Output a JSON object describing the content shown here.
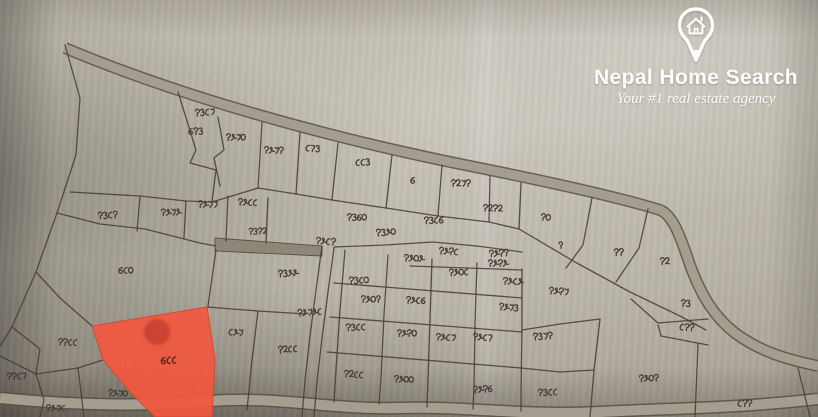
{
  "branding": {
    "name": "Nepal Home Search",
    "tagline": "Your #1 real estate agency",
    "icon": "home-location-pin-icon",
    "text_color": "#ffffff"
  },
  "map": {
    "description": "hand-drawn cadastral parcel sheet photograph with Devanagari plot numbers",
    "colors": {
      "ink": "#463f33",
      "road_fill": "#a59e90",
      "road_edge": "#575045",
      "strip_fill": "#8e8779",
      "paper": "#bab5a9",
      "highlight": "#f2583e",
      "highlight_label": "#63271a",
      "marker": "#c03a2e"
    },
    "highlight": {
      "label": "६८८",
      "label_pos": {
        "x": 168,
        "y": 360
      },
      "polygon": "92,326 207,307 215,360 212,417 155,417 130,392 103,360",
      "marker": {
        "cx": 157,
        "cy": 332,
        "r": 13
      }
    },
    "roads": [
      {
        "name": "top-road",
        "d": "M65,48 C160,88 300,132 470,166 C560,184 625,199 660,210 C673,215 681,238 690,265 C700,292 712,315 735,333 C762,353 790,360 818,366",
        "width": 9
      },
      {
        "name": "bottom-road",
        "d": "M0,398 C80,406 150,406 210,401 C280,396 330,410 400,408 C470,406 520,416 600,412 C680,408 740,408 818,399",
        "width": 10
      }
    ],
    "road_strip": {
      "points": "215,238 322,246 322,256 215,251",
      "label": "१३१२",
      "label_pos": {
        "x": 257,
        "y": 231
      }
    },
    "lines": [
      "65,45 80,98 76,155 57,213 36,272 12,327 0,346",
      "178,92 196,150 190,163 216,170 212,202",
      "218,117 224,150 214,158 220,186",
      "262,122 258,188",
      "300,133 296,194",
      "338,143 332,200",
      "392,155 386,208",
      "442,165 438,216",
      "490,176 489,222",
      "521,183 519,229",
      "70,192 140,196 186,201 212,202",
      "140,196 137,231",
      "186,201 184,238",
      "228,196 226,241",
      "268,198 266,243",
      "212,202 258,188 296,194 332,200 386,208 438,216 489,222 519,229",
      "519,229 575,262 630,292 680,316 706,330",
      "592,198 583,245 566,268",
      "648,209 639,248 616,282",
      "631,299 658,323",
      "658,323 708,319",
      "658,325 661,336 708,345",
      "600,319 594,370 590,417",
      "698,344 695,417",
      "798,368 810,417",
      "522,330 560,324 600,319",
      "521,368 560,372 594,370",
      "57,213 100,224 145,229 200,243 216,246",
      "334,247 385,245 433,242 477,246 522,252",
      "410,266 522,270",
      "334,283 522,298",
      "330,317 522,332",
      "327,352 521,368",
      "345,250 340,310 336,370 334,402",
      "388,255 384,315 381,378 379,404",
      "432,259 430,320 428,380 427,407",
      "477,263 475,324 474,384 473,409",
      "522,269 522,330 521,392 521,411",
      "322,246 316,290 310,336 305,380 302,417",
      "334,248 328,292 322,338 317,382 314,417",
      "216,250 208,306",
      "207,307 258,311 306,314",
      "36,272 60,298 92,326",
      "258,311 252,360 247,410",
      "12,327 40,349 36,374",
      "0,356 36,374",
      "36,374 78,368 103,360",
      "78,368 84,417",
      "36,374 44,400 40,417"
    ],
    "labels": [
      {
        "x": 204,
        "y": 112,
        "t": "१३८७"
      },
      {
        "x": 195,
        "y": 131,
        "t": "६९३"
      },
      {
        "x": 235,
        "y": 137,
        "t": "१४७०"
      },
      {
        "x": 273,
        "y": 150,
        "t": "१४७१"
      },
      {
        "x": 312,
        "y": 148,
        "t": "८५३"
      },
      {
        "x": 362,
        "y": 162,
        "t": "८८३"
      },
      {
        "x": 412,
        "y": 180,
        "t": "६"
      },
      {
        "x": 460,
        "y": 183,
        "t": "१२७१"
      },
      {
        "x": 492,
        "y": 208,
        "t": "१२१२"
      },
      {
        "x": 545,
        "y": 217,
        "t": "१०"
      },
      {
        "x": 560,
        "y": 245,
        "t": "९"
      },
      {
        "x": 618,
        "y": 252,
        "t": "११"
      },
      {
        "x": 664,
        "y": 261,
        "t": "१२"
      },
      {
        "x": 685,
        "y": 303,
        "t": "१३"
      },
      {
        "x": 686,
        "y": 327,
        "t": "८११"
      },
      {
        "x": 107,
        "y": 215,
        "t": "१३८१"
      },
      {
        "x": 170,
        "y": 212,
        "t": "१४७४"
      },
      {
        "x": 207,
        "y": 204,
        "t": "१४७७"
      },
      {
        "x": 247,
        "y": 202,
        "t": "१४८८"
      },
      {
        "x": 325,
        "y": 241,
        "t": "१४८१"
      },
      {
        "x": 385,
        "y": 232,
        "t": "१३४०"
      },
      {
        "x": 433,
        "y": 220,
        "t": "१३८६"
      },
      {
        "x": 356,
        "y": 217,
        "t": "१३६०"
      },
      {
        "x": 413,
        "y": 258,
        "t": "१४०४"
      },
      {
        "x": 448,
        "y": 251,
        "t": "१४१८"
      },
      {
        "x": 498,
        "y": 253,
        "t": "१४१९"
      },
      {
        "x": 458,
        "y": 272,
        "t": "१४०८"
      },
      {
        "x": 497,
        "y": 263,
        "t": "१४१४"
      },
      {
        "x": 512,
        "y": 281,
        "t": "१४८४"
      },
      {
        "x": 558,
        "y": 291,
        "t": "१४१७"
      },
      {
        "x": 287,
        "y": 273,
        "t": "१३४४"
      },
      {
        "x": 358,
        "y": 280,
        "t": "१३८०"
      },
      {
        "x": 370,
        "y": 299,
        "t": "१४०९"
      },
      {
        "x": 415,
        "y": 300,
        "t": "१४८६"
      },
      {
        "x": 508,
        "y": 307,
        "t": "१४७३"
      },
      {
        "x": 309,
        "y": 312,
        "t": "१४७४८"
      },
      {
        "x": 355,
        "y": 327,
        "t": "१३८८"
      },
      {
        "x": 406,
        "y": 333,
        "t": "१४१०"
      },
      {
        "x": 445,
        "y": 337,
        "t": "१४८७"
      },
      {
        "x": 482,
        "y": 337,
        "t": "१४८५"
      },
      {
        "x": 542,
        "y": 336,
        "t": "१३७१"
      },
      {
        "x": 648,
        "y": 378,
        "t": "१४०१"
      },
      {
        "x": 744,
        "y": 403,
        "t": "८११"
      },
      {
        "x": 403,
        "y": 379,
        "t": "१४००"
      },
      {
        "x": 353,
        "y": 374,
        "t": "१२८८"
      },
      {
        "x": 482,
        "y": 389,
        "t": "१४१६"
      },
      {
        "x": 547,
        "y": 392,
        "t": "१३८८"
      },
      {
        "x": 125,
        "y": 270,
        "t": "६८०"
      },
      {
        "x": 67,
        "y": 342,
        "t": "११८८"
      },
      {
        "x": 235,
        "y": 332,
        "t": "८४७"
      },
      {
        "x": 287,
        "y": 349,
        "t": "१२८८"
      },
      {
        "x": 16,
        "y": 376,
        "t": "११८५"
      },
      {
        "x": 55,
        "y": 408,
        "t": "१४७८"
      },
      {
        "x": 117,
        "y": 393,
        "t": "१४७०"
      }
    ]
  }
}
